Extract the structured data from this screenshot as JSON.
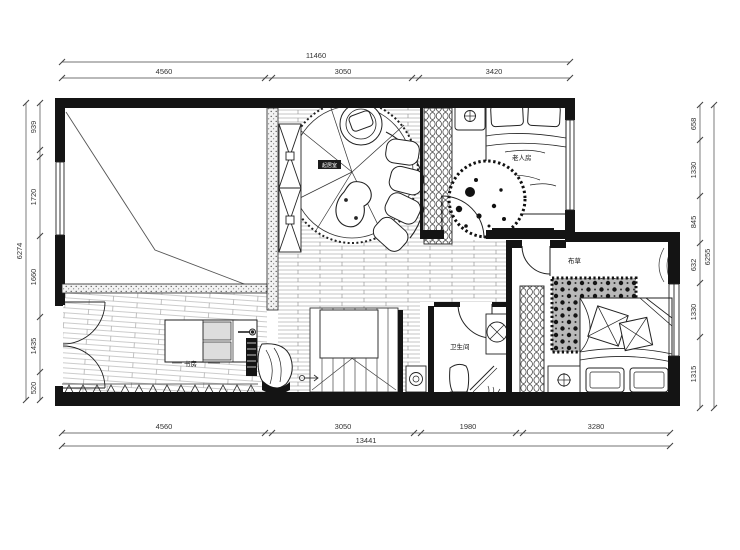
{
  "plan": {
    "rooms": {
      "living": "起居室",
      "elder": "老人房",
      "bath": "卫生间",
      "study": "书房",
      "guest": "布草"
    },
    "dimensions": {
      "top": {
        "total": "11460",
        "segments": [
          "4560",
          "3050",
          "3420"
        ]
      },
      "bottom": {
        "total": "13441",
        "segments": [
          "4560",
          "3050",
          "1980",
          "3280"
        ]
      },
      "left": {
        "total": "6274",
        "segments": [
          "939",
          "1720",
          "1660",
          "1435",
          "520"
        ]
      },
      "right": {
        "total": "6255",
        "segments": [
          "658",
          "1330",
          "845",
          "632",
          "1330",
          "1315"
        ]
      }
    },
    "colors": {
      "wall": "#141414",
      "line": "#2a2a2a",
      "background": "#ffffff"
    }
  }
}
